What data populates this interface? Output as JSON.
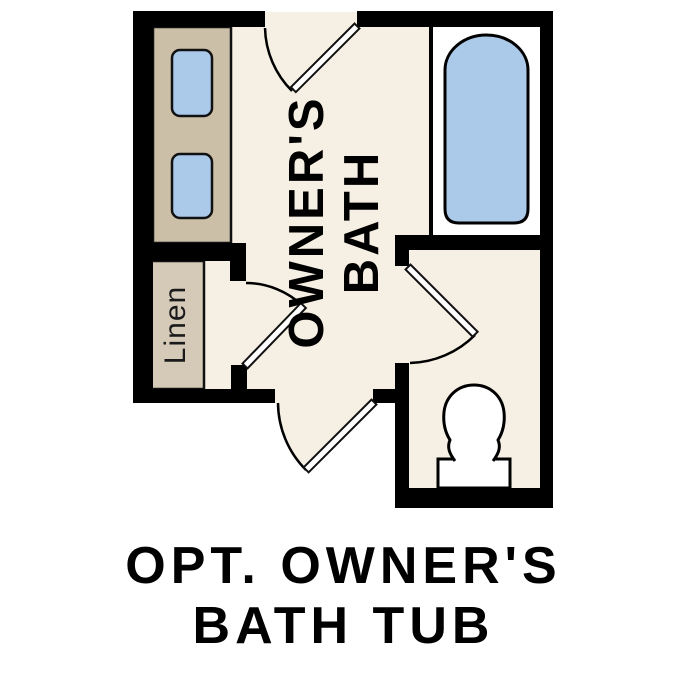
{
  "plan": {
    "room_label": {
      "line1": "OWNER'S",
      "line2": "BATH"
    },
    "linen_label": "Linen",
    "colors": {
      "wall": "#000000",
      "floor": "#f6efe3",
      "counter": "#cbc0a7",
      "linen_shelf": "#d4cab7",
      "fixture_blue": "#abc9e8",
      "fixture_white": "#ffffff"
    }
  },
  "caption": {
    "line1": "OPT. OWNER'S",
    "line2": "BATH TUB"
  }
}
